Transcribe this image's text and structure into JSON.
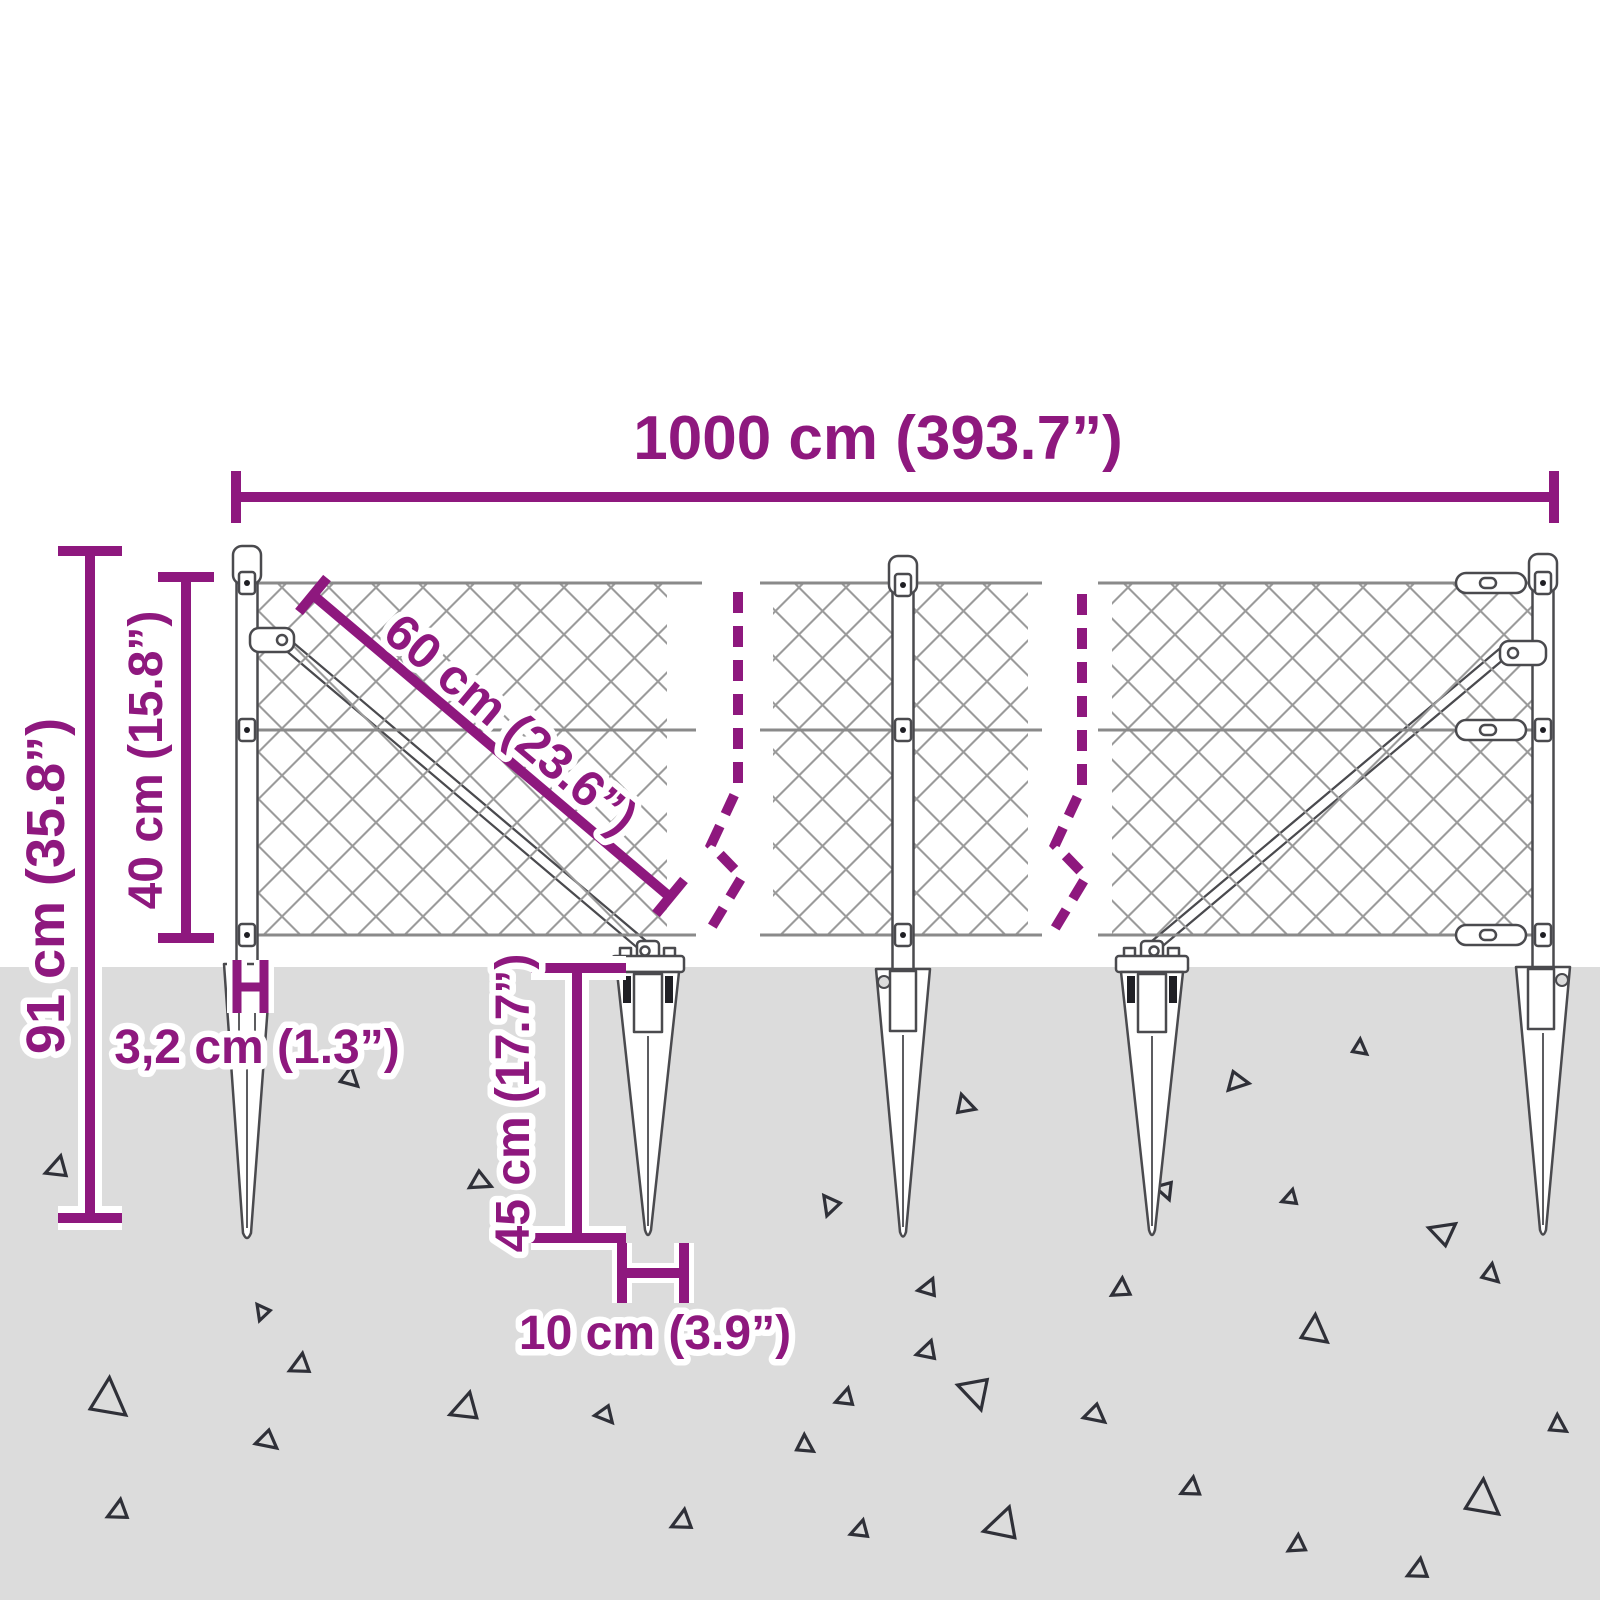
{
  "figure": {
    "type": "product dimension diagram",
    "subject": "chain-link fence kit with pointed ground spike anchors, side view",
    "background_color": "#FFFFFF",
    "accent_color": "#8E187E",
    "ground_color": "#DCDCDC",
    "drawing_outline_color": "#4A4A4E",
    "mesh_color": "#9B9B9B",
    "triangle_color": "#2F3038",
    "ground_texture": "scattered outlined triangles",
    "dimensions": {
      "fence_length": "1000 cm (393.7”)",
      "total_height": "91 cm (35.8”)",
      "mesh_height": "40 cm (15.8”)",
      "brace_length": "60 cm (23.6”)",
      "post_width": "3,2 cm (1.3”)",
      "spike_length": "45 cm (17.7”)",
      "spike_width": "10 cm (3.9”)"
    }
  }
}
